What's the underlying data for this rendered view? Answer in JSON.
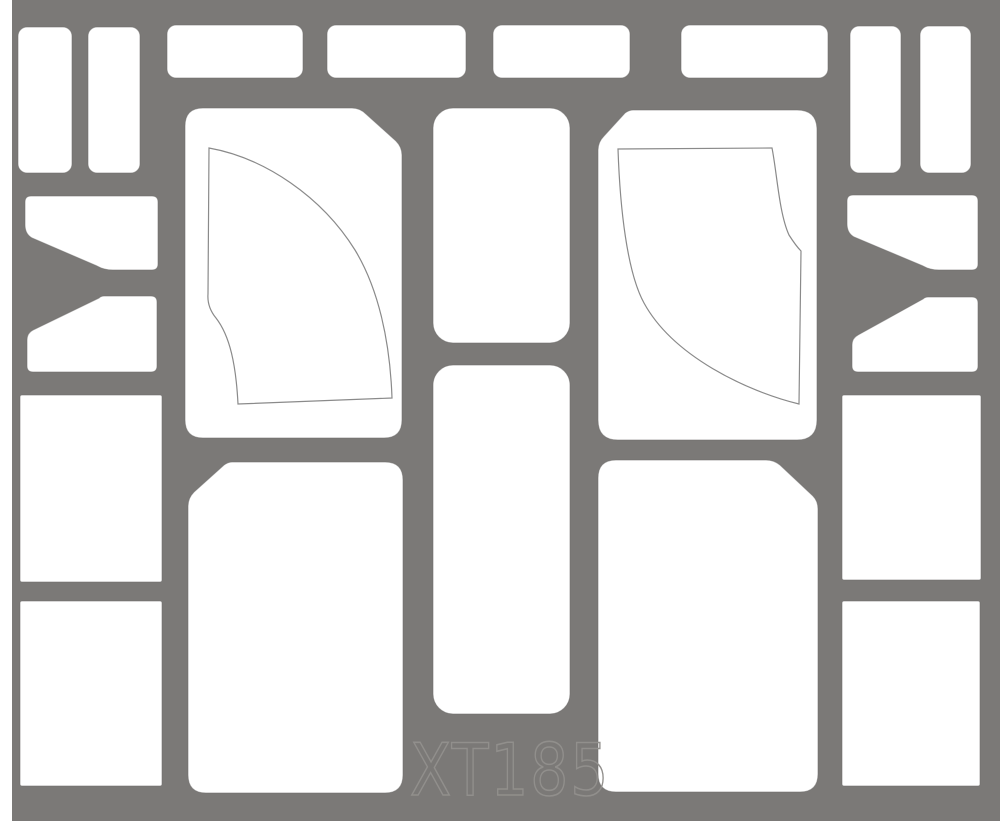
{
  "sheet": {
    "description": "die-cut paint mask sheet",
    "label_text": "XT185"
  },
  "colors": {
    "page": "#ffffff",
    "sheet": "#7b7977",
    "cutout": "#ffffff",
    "cut_edge": "#6d6b69",
    "scribe": "#8a8a8a",
    "label": "#918f8c"
  },
  "label": {
    "text": "XT185"
  },
  "sheet_geometry": {
    "x": 12,
    "y": 0,
    "width": 988,
    "height": 821
  },
  "shapes": [
    {
      "id": "strip-left-a",
      "kind": "rect",
      "x": 18,
      "y": 27,
      "w": 54,
      "h": 146,
      "r": 9
    },
    {
      "id": "strip-left-b",
      "kind": "rect",
      "x": 88,
      "y": 27,
      "w": 52,
      "h": 146,
      "r": 9
    },
    {
      "id": "strip-top-1",
      "kind": "rect",
      "x": 167,
      "y": 25,
      "w": 136,
      "h": 53,
      "r": 9
    },
    {
      "id": "strip-top-2",
      "kind": "rect",
      "x": 327,
      "y": 25,
      "w": 139,
      "h": 53,
      "r": 9
    },
    {
      "id": "strip-top-3",
      "kind": "rect",
      "x": 493,
      "y": 25,
      "w": 137,
      "h": 53,
      "r": 9
    },
    {
      "id": "strip-top-4",
      "kind": "rect",
      "x": 681,
      "y": 25,
      "w": 147,
      "h": 53,
      "r": 9
    },
    {
      "id": "strip-right-a",
      "kind": "rect",
      "x": 850,
      "y": 26,
      "w": 51,
      "h": 147,
      "r": 9
    },
    {
      "id": "strip-right-b",
      "kind": "rect",
      "x": 920,
      "y": 26,
      "w": 51,
      "h": 147,
      "r": 9
    },
    {
      "id": "square-left-1",
      "kind": "rect",
      "x": 20,
      "y": 395,
      "w": 142,
      "h": 187,
      "r": 2
    },
    {
      "id": "square-left-2",
      "kind": "rect",
      "x": 20,
      "y": 601,
      "w": 142,
      "h": 185,
      "r": 2
    },
    {
      "id": "square-right-1",
      "kind": "rect",
      "x": 842,
      "y": 395,
      "w": 139,
      "h": 185,
      "r": 2
    },
    {
      "id": "square-right-2",
      "kind": "rect",
      "x": 842,
      "y": 601,
      "w": 138,
      "h": 185,
      "r": 2
    },
    {
      "id": "center-column-1",
      "kind": "rect",
      "x": 433,
      "y": 108,
      "w": 137,
      "h": 235,
      "r": 20
    },
    {
      "id": "center-column-2",
      "kind": "rect",
      "x": 433,
      "y": 365,
      "w": 137,
      "h": 349,
      "r": 20
    },
    {
      "id": "wedge-left-upper",
      "kind": "path",
      "d": "M31,196 L152,196 Q158,196 158,202 L158,264 Q158,270 152,270 L113,270 Q104,270 97,266 L32,238 Q25,234 25,225 L25,202 Q25,196 31,196 Z"
    },
    {
      "id": "wedge-left-lower",
      "kind": "path",
      "d": "M104,296 L151,296 Q157,296 157,302 L157,366 Q157,372 151,372 L33,372 Q27,372 27,366 L27,340 Q27,333 33,330 L99,298 Q101,296 104,296 Z"
    },
    {
      "id": "wedge-right-upper",
      "kind": "path",
      "d": "M853,195 L972,195 Q978,195 978,201 L978,264 Q978,270 972,270 L939,270 Q930,270 923,266 L854,237 Q847,233 847,224 L847,201 Q847,195 853,195 Z"
    },
    {
      "id": "wedge-right-lower",
      "kind": "path",
      "d": "M928,297 L972,297 Q978,297 978,303 L978,366 Q978,372 972,372 L858,372 Q852,372 852,366 L852,345 Q852,338 858,335 L923,299 Q925,297 928,297 Z"
    },
    {
      "id": "panel-upper-left",
      "kind": "path",
      "d": "M203,108 L352,108 Q360,108 366,114 L396,141 Q402,147 402,155 L402,420 Q402,438 384,438 L203,438 Q185,438 185,420 L185,126 Q185,108 203,108 Z"
    },
    {
      "id": "panel-upper-right",
      "kind": "path",
      "d": "M633,110 L797,110 Q817,110 817,130 L817,420 Q817,440 797,440 L618,440 Q598,440 598,420 L598,150 Q598,142 604,136 L625,113 Q629,110 633,110 Z"
    },
    {
      "id": "panel-lower-left",
      "kind": "path",
      "d": "M232,462 L385,462 Q403,462 403,480 L403,775 Q403,793 385,793 L206,793 Q188,793 188,775 L188,506 Q188,498 194,492 L224,465 Q228,462 232,462 Z"
    },
    {
      "id": "panel-lower-right",
      "kind": "path",
      "d": "M616,460 L766,460 Q774,460 780,465 L813,496 Q818,501 818,509 L818,774 Q818,792 800,792 L616,792 Q598,792 598,774 L598,478 Q598,460 616,460 Z"
    }
  ],
  "scribe_lines": [
    {
      "id": "windshield-outline-left",
      "d": "M209,148 C265,158 322,197 355,250 C378,288 390,340 392,398 L238,404 C236,365 230,336 216,318 Q207,307 208,294 L209,148 Z"
    },
    {
      "id": "windshield-outline-right",
      "d": "M618,149 L772,148 C777,173 779,213 789,235 Q796,246 801,251 L799,404 C746,391 673,356 644,303 C627,272 620,208 618,149 Z"
    }
  ]
}
